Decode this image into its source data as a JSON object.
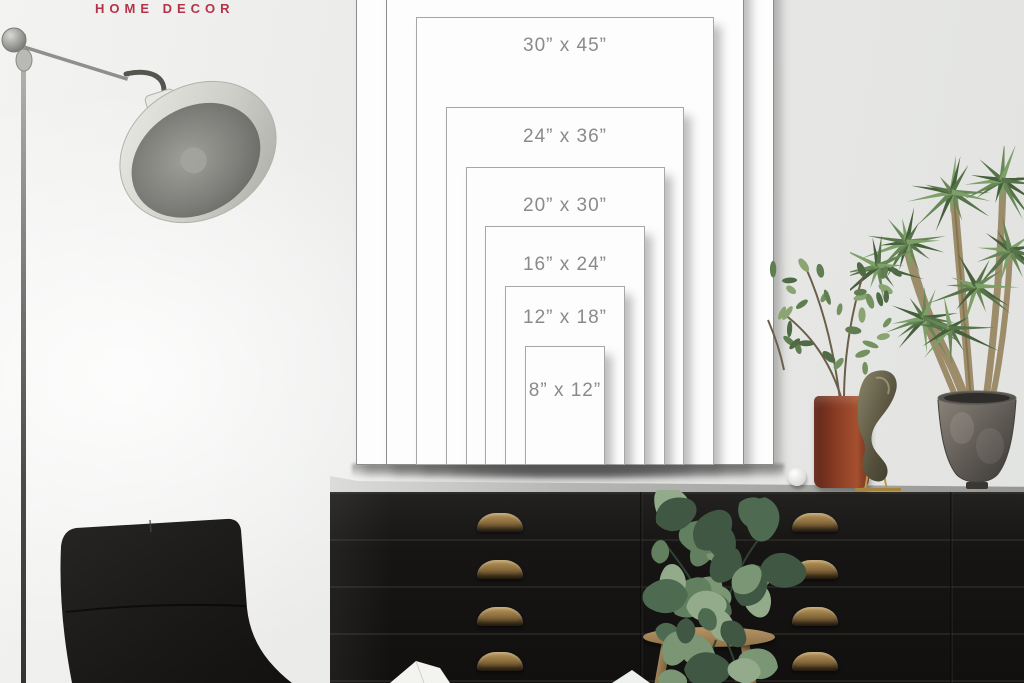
{
  "brand": {
    "label": "HOME DECOR",
    "color": "#b53349"
  },
  "size_chart": {
    "unit": "inches",
    "label_color": "#8a8a8a",
    "frame_color": "#fdfdfd",
    "frames": [
      {
        "label": "",
        "width_in": 42,
        "height_in": 63
      },
      {
        "label": "",
        "width_in": 36,
        "height_in": 54
      },
      {
        "label": "30” x 45”",
        "width_in": 30,
        "height_in": 45
      },
      {
        "label": "24” x 36”",
        "width_in": 24,
        "height_in": 36
      },
      {
        "label": "20” x 30”",
        "width_in": 20,
        "height_in": 30
      },
      {
        "label": "16” x 24”",
        "width_in": 16,
        "height_in": 24
      },
      {
        "label": "12” x 18”",
        "width_in": 12,
        "height_in": 18
      },
      {
        "label": "8” x 12”",
        "width_in": 8,
        "height_in": 12
      }
    ]
  },
  "scene": {
    "colors": {
      "wall": "#e9eae8",
      "dresser": "#161514",
      "brass_handle": "#8f7140",
      "chair": "#1c1b1a",
      "vase": "#8a3b24",
      "lamp_metal": "#cfcfc9",
      "plant_green": "#5d7b4c",
      "wood": "#9c7f55"
    },
    "objects": [
      "floor-lamp",
      "lounge-chair",
      "dresser",
      "drawer-handles",
      "pothos-plant",
      "wooden-stool",
      "ficus-plant",
      "red-vase",
      "bronze-sculpture",
      "white-sphere",
      "metal-pot",
      "dracaena-plant"
    ]
  }
}
